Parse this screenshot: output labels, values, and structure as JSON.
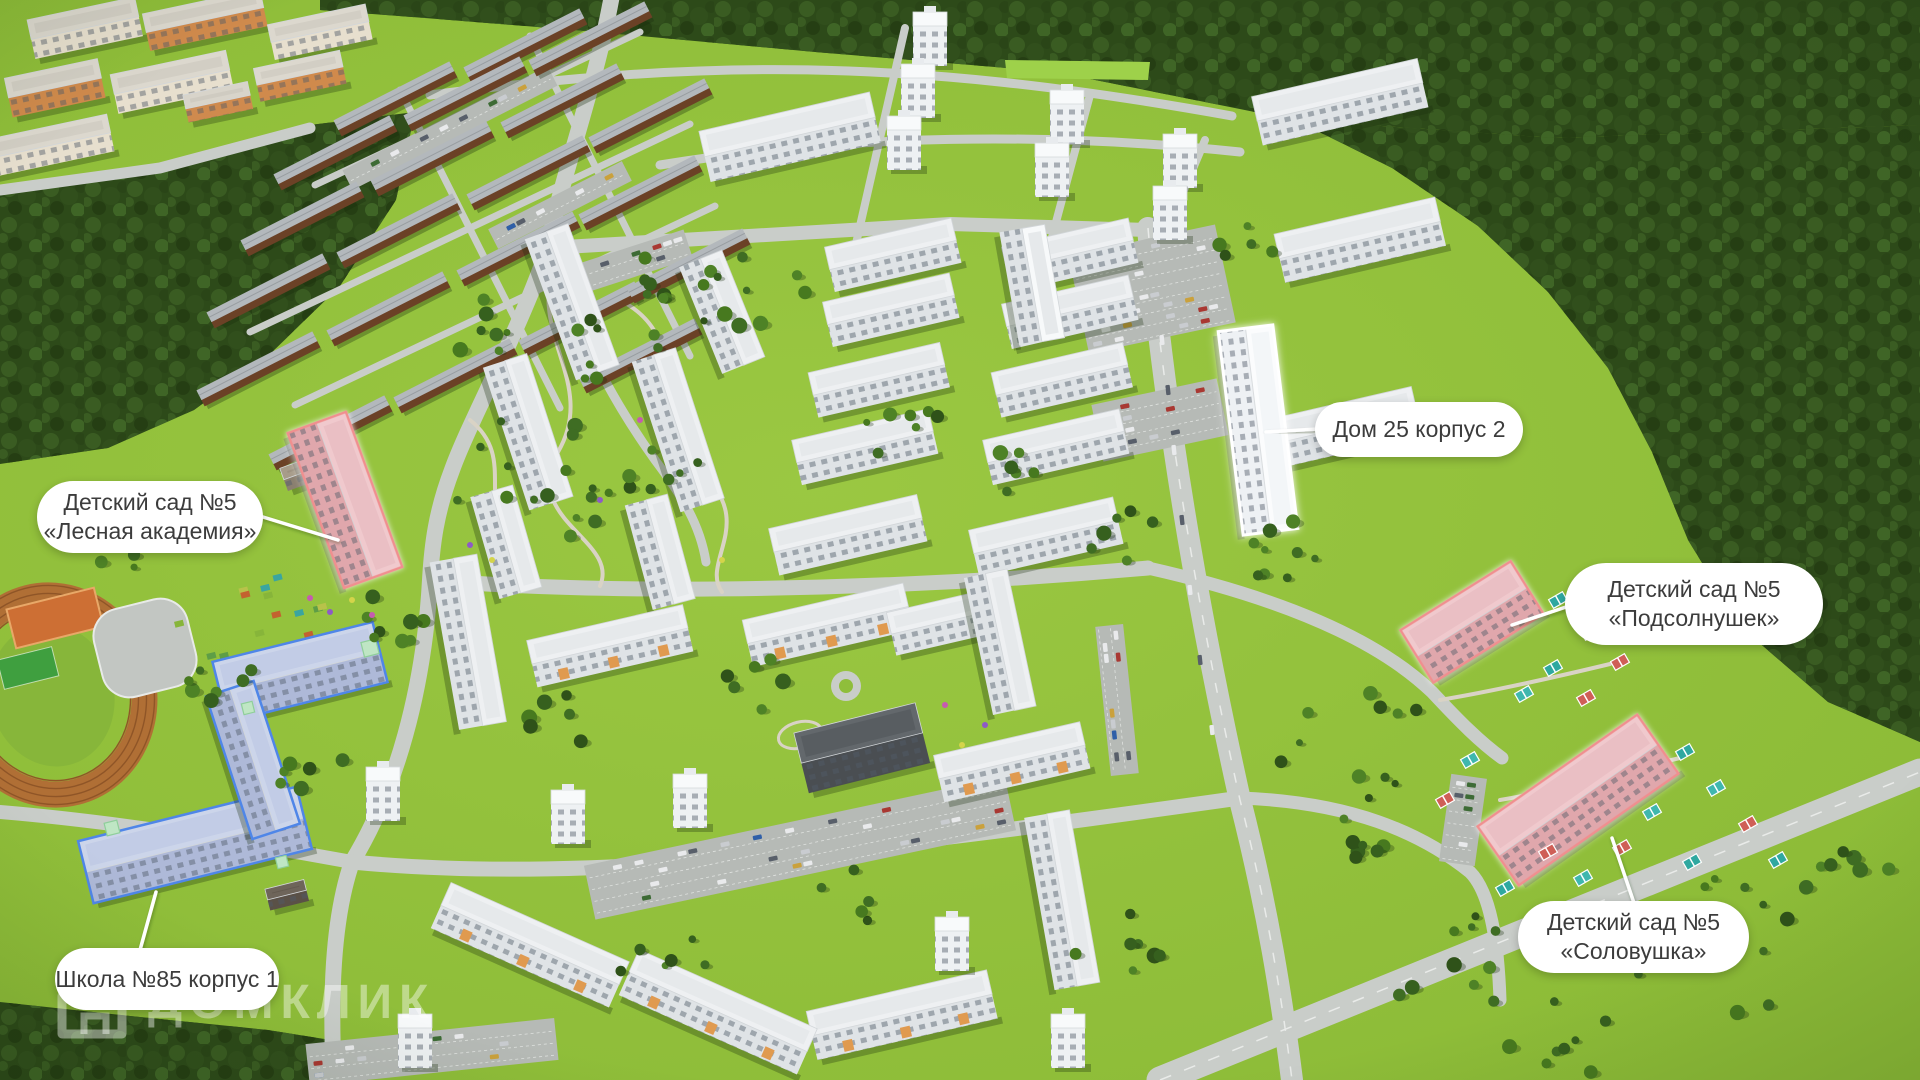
{
  "scene": {
    "description": "3D aerial masterplan render of a residential district with labeled social infrastructure",
    "callouts": [
      {
        "id": "kindergarten-lesnaya-akademiya",
        "lines": [
          "Детский сад №5",
          "«Лесная академия»"
        ]
      },
      {
        "id": "dom-25-korpus-2",
        "lines": [
          "Дом 25 корпус 2"
        ]
      },
      {
        "id": "kindergarten-podsolnushek",
        "lines": [
          "Детский сад №5",
          "«Подсолнушек»"
        ]
      },
      {
        "id": "kindergarten-solovushka",
        "lines": [
          "Детский сад №5",
          "«Соловушка»"
        ]
      },
      {
        "id": "school-85-korpus-1",
        "lines": [
          "Школа №85 корпус 1"
        ]
      }
    ],
    "watermark": {
      "text": "ДОМКЛИК",
      "icon": "house-logo-icon"
    },
    "colors": {
      "label_bg": "#ffffff",
      "label_text": "#3c3c3c",
      "kindergarten_fill": "#e0a7ac",
      "kindergarten_roof": "#f0c9cd",
      "kindergarten_outline": "#f08f8f",
      "school_fill": "#aeb9d8",
      "school_roof": "#ccd5ea",
      "school_outline": "#4f86e8",
      "selected_fill": "#eef1f4",
      "selected_roof": "#fbfcfd",
      "selected_outline": "#ffffff",
      "lawn": "#8cbb37",
      "forest": "#2d4a19",
      "road": "#c9cdc9"
    }
  }
}
